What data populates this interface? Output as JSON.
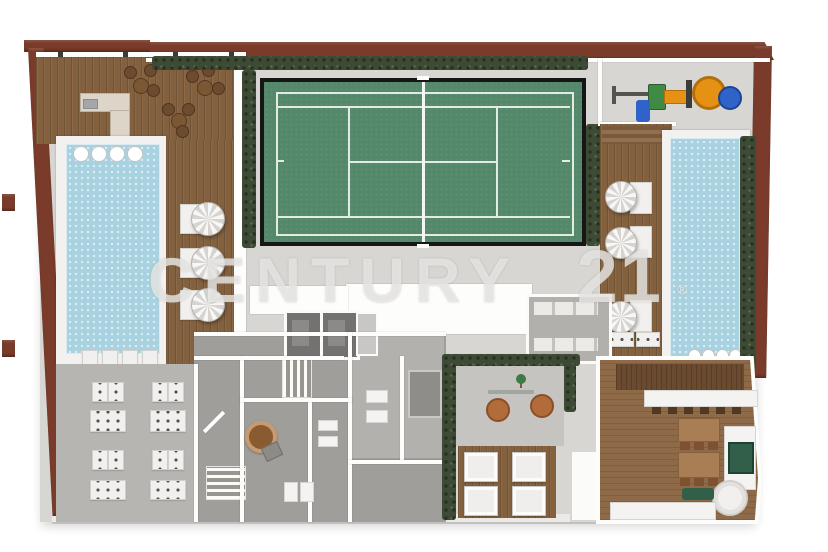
{
  "watermark": {
    "brand": "CENTURY",
    "number": "21",
    "registered": "®"
  },
  "colors": {
    "outer_wall": "#7a3b2a",
    "wood_deck": "#83613f",
    "wood_dining": "#8f6a49",
    "wood_dark": "#6b4b30",
    "tennis_court": "#54886b",
    "court_line": "#e3ece4",
    "pool_water": "#a8d2e0",
    "hedge": "#3d4a35",
    "concrete": "#d8d6d2",
    "interior_floor": "#a09e9b",
    "lounge_floor": "#b7b5b2",
    "playground_orange": "#e59114",
    "playground_blue": "#2f63c9",
    "playground_green": "#3f8a45",
    "grill_green": "#315f49",
    "watermark_gray": "#dcdbd8"
  }
}
